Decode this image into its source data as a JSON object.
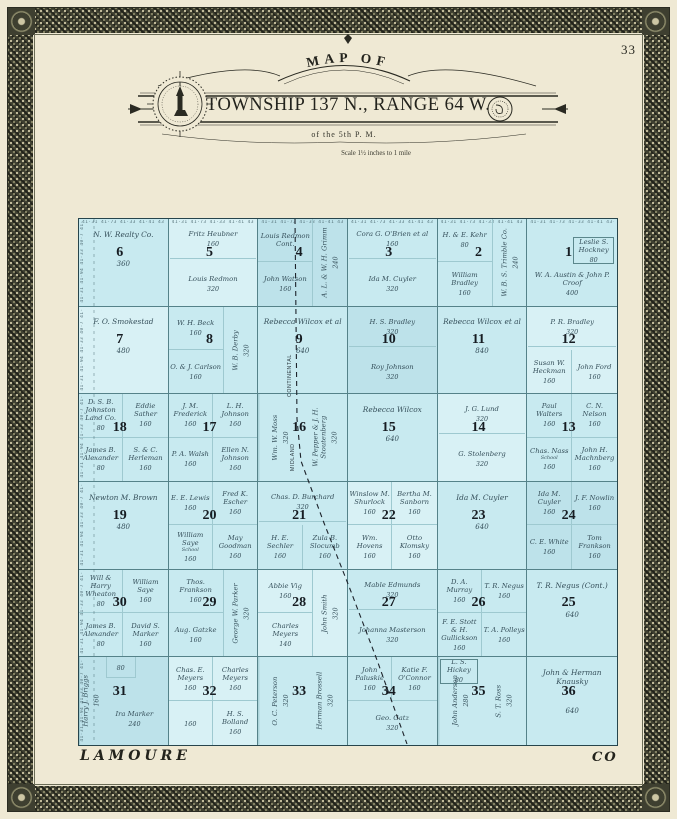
{
  "page": {
    "number": "33"
  },
  "title": {
    "arc": "MAP OF",
    "main": "TOWNSHIP 137 N., RANGE 64 W.",
    "sub": "of the 5th P. M.",
    "scale": "Scale 1½ inches to 1 mile"
  },
  "county": {
    "left": "LAMOURE",
    "right": "CO"
  },
  "railroad": {
    "name": "MIDLAND CONTINENTAL",
    "label_upper": "CONTINENTAL",
    "label_lower": "MIDLAND"
  },
  "edge_numbers": {
    "top": "41·31 41·73 41·33 41·41 43·00 40·97 40·3 41·7",
    "left": "41·31 41·94 41·33 40·7 41·7"
  },
  "colors": {
    "paper": "#efe9d4",
    "map_water_blue": "#c8eaf0",
    "grid_line": "#558289",
    "border_band": "#3e3f30",
    "ink": "#2a2a22",
    "parcel_ink": "#36505b"
  },
  "sections": [
    {
      "num": "6",
      "parcels": [
        {
          "n": "N. W. Realty Co.",
          "a": "360",
          "pos": "full"
        }
      ]
    },
    {
      "num": "5",
      "parcels": [
        {
          "n": "Fritz Heubner",
          "a": "160",
          "pos": "top"
        },
        {
          "n": "Louis Redmon",
          "a": "320",
          "pos": "bottom"
        }
      ]
    },
    {
      "num": "4",
      "parcels": [
        {
          "n": "Louis Redmon Cont.",
          "a": "",
          "pos": "tl-wide"
        },
        {
          "n": "John Watson",
          "a": "160",
          "pos": "bl-wide"
        },
        {
          "n": "A. L. & W. H. Grimm",
          "a": "240",
          "pos": "strip-right"
        }
      ]
    },
    {
      "num": "3",
      "parcels": [
        {
          "n": "Cora G. O'Brien et al",
          "a": "160",
          "pos": "top"
        },
        {
          "n": "Ida M. Cuyler",
          "a": "320",
          "pos": "bottom"
        }
      ]
    },
    {
      "num": "2",
      "parcels": [
        {
          "n": "H. & E. Kehr",
          "a": "80",
          "pos": "tl-wide"
        },
        {
          "n": "William Bradley",
          "a": "160",
          "pos": "bl-wide"
        },
        {
          "n": "W. B. S. Trimble Co.",
          "a": "240",
          "pos": "strip-right"
        }
      ]
    },
    {
      "num": "1",
      "parcels": [
        {
          "n": "Leslie S. Hockney",
          "a": "80",
          "pos": "tr-small"
        },
        {
          "n": "W. A. Austin & John P. Croof",
          "a": "400",
          "pos": "bottom"
        }
      ]
    },
    {
      "num": "7",
      "parcels": [
        {
          "n": "F. O. Smokestad",
          "a": "480",
          "pos": "full"
        }
      ]
    },
    {
      "num": "8",
      "parcels": [
        {
          "n": "W. H. Beck",
          "a": "160",
          "pos": "tl-wide"
        },
        {
          "n": "O. & J. Carlson",
          "a": "160",
          "pos": "bl-wide"
        },
        {
          "n": "W. B. Derby",
          "a": "320",
          "pos": "strip-right"
        }
      ]
    },
    {
      "num": "9",
      "parcels": [
        {
          "n": "Rebecca Wilcox et al",
          "a": "640",
          "pos": "full"
        }
      ]
    },
    {
      "num": "10",
      "parcels": [
        {
          "n": "H. S. Bradley",
          "a": "320",
          "pos": "top"
        },
        {
          "n": "Roy Johnson",
          "a": "320",
          "pos": "bottom"
        }
      ]
    },
    {
      "num": "11",
      "parcels": [
        {
          "n": "Rebecca Wilcox et al",
          "a": "840",
          "pos": "full"
        }
      ]
    },
    {
      "num": "12",
      "parcels": [
        {
          "n": "P. R. Bradley",
          "a": "320",
          "pos": "top"
        },
        {
          "n": "Susan W. Heckman",
          "a": "160",
          "pos": "bl"
        },
        {
          "n": "John Ford",
          "a": "160",
          "pos": "br"
        }
      ]
    },
    {
      "num": "18",
      "parcels": [
        {
          "n": "D. S. B. Johnston Land Co.",
          "a": "80",
          "pos": "tl"
        },
        {
          "n": "Eddie Sather",
          "a": "160",
          "pos": "tr"
        },
        {
          "n": "James B. Alexander",
          "a": "80",
          "pos": "bl"
        },
        {
          "n": "S. & C. Herleman",
          "a": "160",
          "pos": "br"
        }
      ]
    },
    {
      "num": "17",
      "parcels": [
        {
          "n": "J. M. Frederick",
          "a": "160",
          "pos": "tl"
        },
        {
          "n": "L. H. Johnson",
          "a": "160",
          "pos": "tr"
        },
        {
          "n": "P. A. Walsh",
          "a": "160",
          "pos": "bl"
        },
        {
          "n": "Ellen N. Johnson",
          "a": "160",
          "pos": "br"
        }
      ]
    },
    {
      "num": "16",
      "parcels": [
        {
          "n": "Wm. W. Moss",
          "a": "320",
          "pos": "v-left"
        },
        {
          "n": "W. Pepper & J. H. Stoutenberg",
          "a": "320",
          "pos": "v-right"
        }
      ]
    },
    {
      "num": "15",
      "parcels": [
        {
          "n": "Rebecca Wilcox",
          "a": "640",
          "pos": "full"
        }
      ]
    },
    {
      "num": "14",
      "parcels": [
        {
          "n": "J. G. Lund",
          "a": "320",
          "pos": "top"
        },
        {
          "n": "G. Stolenberg",
          "a": "320",
          "pos": "bottom"
        }
      ]
    },
    {
      "num": "13",
      "parcels": [
        {
          "n": "Paul Walters",
          "a": "160",
          "pos": "tl"
        },
        {
          "n": "C. N. Nelson",
          "a": "160",
          "pos": "tr"
        },
        {
          "n": "Chas. Nass",
          "a": "160",
          "pos": "bl",
          "note": "School"
        },
        {
          "n": "John H. Machnberg",
          "a": "160",
          "pos": "br"
        }
      ]
    },
    {
      "num": "19",
      "parcels": [
        {
          "n": "Newton M. Brown",
          "a": "480",
          "pos": "full"
        }
      ]
    },
    {
      "num": "20",
      "parcels": [
        {
          "n": "E. E. Lewis",
          "a": "160",
          "pos": "tl"
        },
        {
          "n": "Fred K. Escher",
          "a": "160",
          "pos": "tr"
        },
        {
          "n": "William Saye",
          "a": "160",
          "pos": "bl",
          "note": "School"
        },
        {
          "n": "May Goodman",
          "a": "160",
          "pos": "br"
        }
      ]
    },
    {
      "num": "21",
      "parcels": [
        {
          "n": "Chas. D. Burchard",
          "a": "320",
          "pos": "top"
        },
        {
          "n": "H. E. Sechler",
          "a": "160",
          "pos": "bl"
        },
        {
          "n": "Zula B. Slocumb",
          "a": "160",
          "pos": "br"
        }
      ]
    },
    {
      "num": "22",
      "parcels": [
        {
          "n": "Winslow M. Shurlock",
          "a": "160",
          "pos": "tl"
        },
        {
          "n": "Bertha M. Sanborn",
          "a": "160",
          "pos": "tr"
        },
        {
          "n": "Wm. Hovens",
          "a": "160",
          "pos": "bl"
        },
        {
          "n": "Otto Klomsky",
          "a": "160",
          "pos": "br"
        }
      ]
    },
    {
      "num": "23",
      "parcels": [
        {
          "n": "Ida M. Cuyler",
          "a": "640",
          "pos": "full"
        }
      ]
    },
    {
      "num": "24",
      "parcels": [
        {
          "n": "Ida M. Cuyler",
          "a": "160",
          "pos": "tl"
        },
        {
          "n": "J. F. Nowlin",
          "a": "160",
          "pos": "tr"
        },
        {
          "n": "C. E. White",
          "a": "160",
          "pos": "bl"
        },
        {
          "n": "Tom Frankson",
          "a": "160",
          "pos": "br"
        }
      ]
    },
    {
      "num": "30",
      "parcels": [
        {
          "n": "Will & Harry Wheaton",
          "a": "80",
          "pos": "tl"
        },
        {
          "n": "William Saye",
          "a": "160",
          "pos": "tr"
        },
        {
          "n": "James B. Alexander",
          "a": "80",
          "pos": "bl"
        },
        {
          "n": "David S. Marker",
          "a": "160",
          "pos": "br"
        }
      ]
    },
    {
      "num": "29",
      "parcels": [
        {
          "n": "Thos. Frankson",
          "a": "160",
          "pos": "tl-wide"
        },
        {
          "n": "Aug. Gatzke",
          "a": "160",
          "pos": "bl-wide"
        },
        {
          "n": "George W. Parker",
          "a": "320",
          "pos": "strip-right"
        }
      ]
    },
    {
      "num": "28",
      "parcels": [
        {
          "n": "Abbie Vig",
          "a": "160",
          "pos": "tl-wide"
        },
        {
          "n": "Charles Meyers",
          "a": "140",
          "pos": "bl-wide"
        },
        {
          "n": "John Smith",
          "a": "320",
          "pos": "strip-right"
        }
      ]
    },
    {
      "num": "27",
      "parcels": [
        {
          "n": "Mable Edmunds",
          "a": "320",
          "pos": "top"
        },
        {
          "n": "Johanna Masterson",
          "a": "320",
          "pos": "bottom"
        }
      ]
    },
    {
      "num": "26",
      "parcels": [
        {
          "n": "D. A. Murray",
          "a": "160",
          "pos": "tl"
        },
        {
          "n": "T. R. Negus",
          "a": "160",
          "pos": "tr"
        },
        {
          "n": "F. E. Stott & H. Gullickson",
          "a": "160",
          "pos": "bl"
        },
        {
          "n": "T. A. Polleys",
          "a": "160",
          "pos": "br"
        }
      ]
    },
    {
      "num": "25",
      "parcels": [
        {
          "n": "T. R. Negus (Cont.)",
          "a": "640",
          "pos": "full"
        }
      ]
    },
    {
      "num": "31",
      "parcels": [
        {
          "n": "Harry J. Briggs",
          "a": "160",
          "pos": "strip-left"
        },
        {
          "n": "",
          "a": "80",
          "pos": "t-small"
        },
        {
          "n": "Ira Marker",
          "a": "240",
          "pos": "main-low"
        }
      ]
    },
    {
      "num": "32",
      "parcels": [
        {
          "n": "Chas. E. Meyers",
          "a": "160",
          "pos": "tl"
        },
        {
          "n": "Charles Meyers",
          "a": "160",
          "pos": "tr"
        },
        {
          "n": "",
          "a": "160",
          "pos": "bl"
        },
        {
          "n": "H. S. Bolland",
          "a": "160",
          "pos": "br"
        }
      ]
    },
    {
      "num": "33",
      "parcels": [
        {
          "n": "O. C. Peterson",
          "a": "320",
          "pos": "v-left"
        },
        {
          "n": "Herman Brossell",
          "a": "320",
          "pos": "v-right"
        }
      ]
    },
    {
      "num": "34",
      "parcels": [
        {
          "n": "John Paluskie",
          "a": "160",
          "pos": "tl"
        },
        {
          "n": "Katie F. O'Connor",
          "a": "160",
          "pos": "tr"
        },
        {
          "n": "Geo. Gatz",
          "a": "320",
          "pos": "bottom"
        }
      ]
    },
    {
      "num": "35",
      "parcels": [
        {
          "n": "L. S. Hickey",
          "a": "80",
          "pos": "tl-small"
        },
        {
          "n": "John Anderson",
          "a": "280",
          "pos": "v-left"
        },
        {
          "n": "S. T. Ross",
          "a": "320",
          "pos": "v-right"
        }
      ]
    },
    {
      "num": "36",
      "parcels": [
        {
          "n": "John & Herman Knausky",
          "a": "640",
          "pos": "full"
        }
      ]
    }
  ]
}
